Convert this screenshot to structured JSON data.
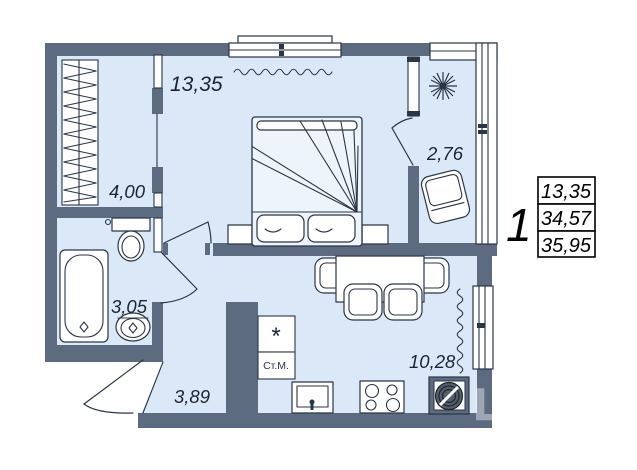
{
  "title": "one-room apartment floor plan",
  "rooms": [
    {
      "id": "bedroom",
      "area": "13,35"
    },
    {
      "id": "wardrobe",
      "area": "4,00"
    },
    {
      "id": "balcony",
      "area": "2,76"
    },
    {
      "id": "bathroom",
      "area": "3,05"
    },
    {
      "id": "hallway",
      "area": "3,89"
    },
    {
      "id": "kitchen",
      "area": "10,28"
    }
  ],
  "appliances": {
    "washing_machine": "Ст.М.",
    "vent_box": "*"
  },
  "summary": {
    "rooms_count": "1",
    "rows": [
      "13,35",
      "34,57",
      "35,95"
    ]
  },
  "watermark": "ЦИАН",
  "colors": {
    "wall": "#5d6b80",
    "floor": "#dbe8f7",
    "line": "#2b3645",
    "summary_border": "#000000"
  }
}
